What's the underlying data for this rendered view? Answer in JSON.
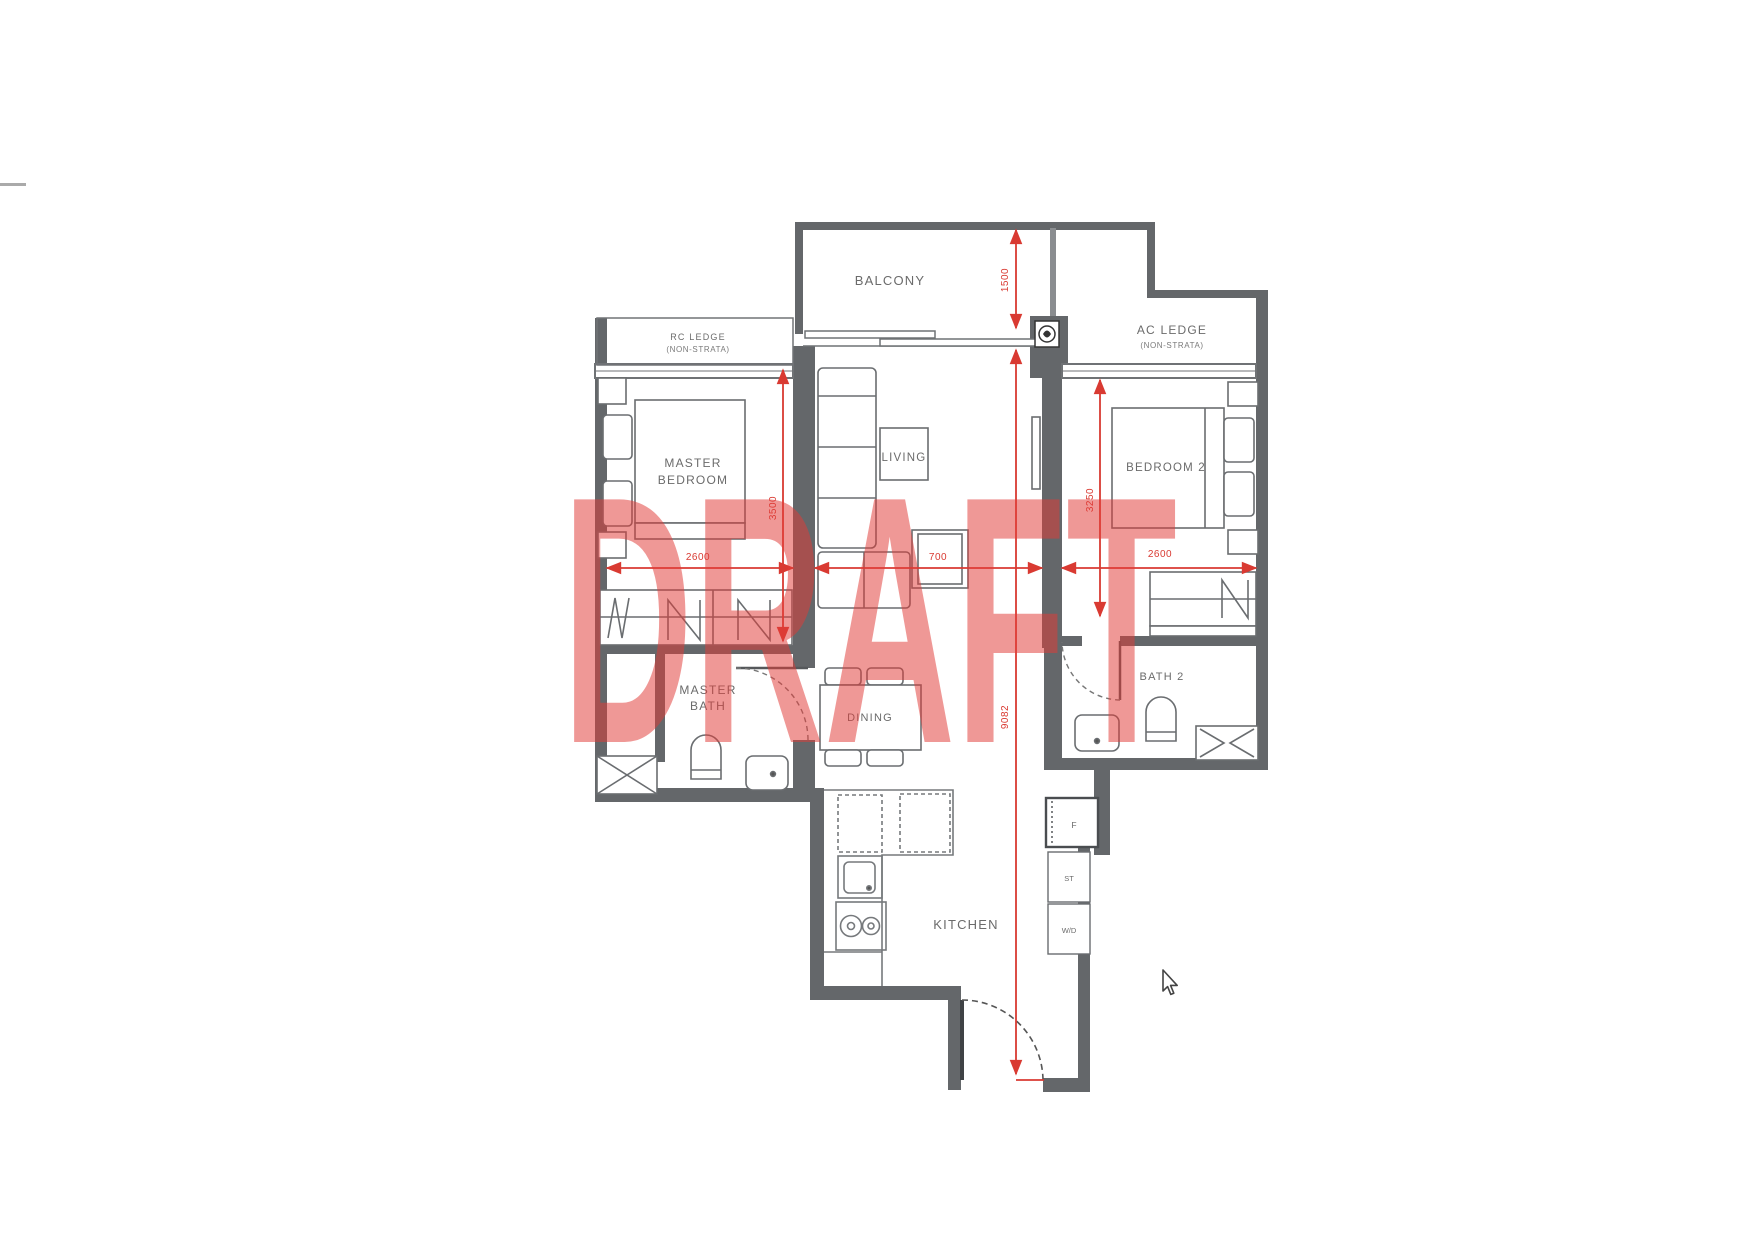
{
  "watermark": "DRAFT",
  "rooms": {
    "balcony": "BALCONY",
    "ac_ledge": "AC LEDGE",
    "ac_ledge_sub": "(NON-STRATA)",
    "rc_ledge": "RC LEDGE",
    "rc_ledge_sub": "(NON-STRATA)",
    "master_bedroom_l1": "MASTER",
    "master_bedroom_l2": "BEDROOM",
    "living": "LIVING",
    "bedroom2": "BEDROOM 2",
    "master_bath_l1": "MASTER",
    "master_bath_l2": "BATH",
    "dining": "DINING",
    "bath2": "BATH 2",
    "kitchen": "KITCHEN"
  },
  "appliances": {
    "fridge": "F",
    "storage": "ST",
    "washer_dryer": "W/D"
  },
  "dims": {
    "master_bedroom_width": "2600",
    "master_bedroom_depth": "3500",
    "bedroom2_width": "2600",
    "bedroom2_depth": "3250",
    "balcony_depth": "1500",
    "overall_depth": "9082",
    "console_width": "700"
  },
  "colors": {
    "wall": "#64676a",
    "line": "#5b5e61",
    "label": "#6b6b6b",
    "dimension": "#d93a32",
    "watermark": "#e23c38"
  }
}
